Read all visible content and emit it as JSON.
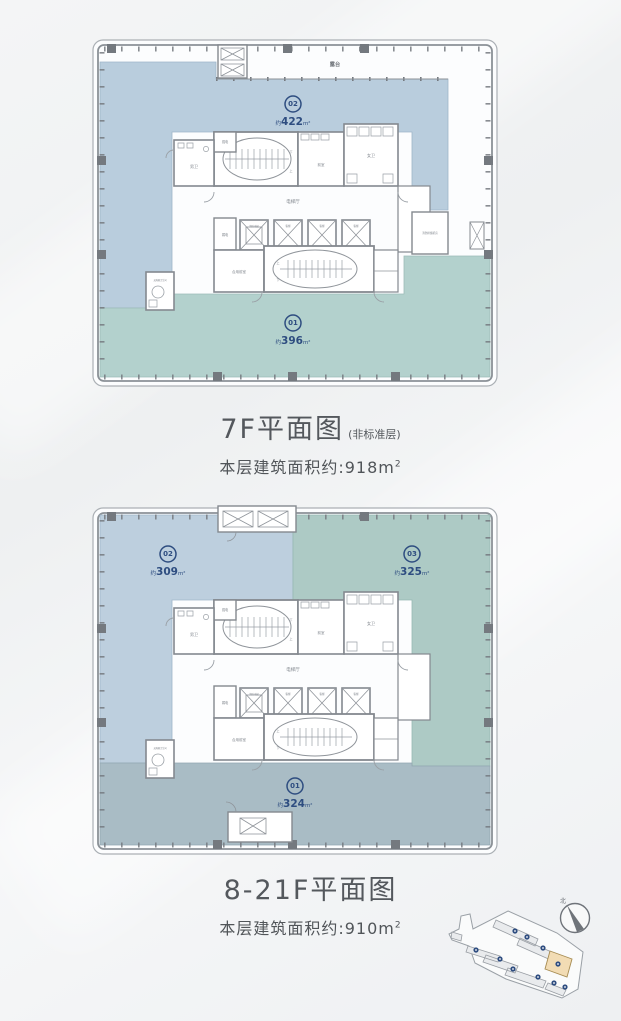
{
  "page": {
    "background_top": "#f4f5f6",
    "background_bottom": "#eef0f2"
  },
  "colors": {
    "badge_blue": "#2e4d80",
    "wall_gray": "#84898f",
    "column_gray": "#74797f",
    "title_gray": "#54585d",
    "label_gray": "#80868d",
    "site_highlight": "#f2dcb4"
  },
  "plan1": {
    "title": "7F平面图",
    "title_note": "(非标准层)",
    "subtitle": "本层建筑面积约:918m",
    "subtitle_sup": "2",
    "units": {
      "u02": {
        "num": "02",
        "prefix": "约",
        "value": "422",
        "suffix": "m²",
        "color": "#b9cddd"
      },
      "u01": {
        "num": "01",
        "prefix": "约",
        "value": "396",
        "suffix": "m²",
        "color": "#b3d1cd"
      }
    },
    "labels": {
      "terrace": "露台",
      "smoke_room": "消防排烟机房"
    }
  },
  "plan2": {
    "title": "8-21F平面图",
    "subtitle": "本层建筑面积约:910m",
    "subtitle_sup": "2",
    "units": {
      "u02": {
        "num": "02",
        "prefix": "约",
        "value": "309",
        "suffix": "m²",
        "color": "#bdcfde"
      },
      "u03": {
        "num": "03",
        "prefix": "约",
        "value": "325",
        "suffix": "m²",
        "color": "#adcac5"
      },
      "u01": {
        "num": "01",
        "prefix": "约",
        "value": "324",
        "suffix": "m²",
        "color": "#a9bcc5"
      }
    }
  },
  "core": {
    "elevator_hall": "电梯厅",
    "male_wc": "男卫",
    "female_wc": "女卫",
    "front_room": "前室",
    "strong_elec": "强电",
    "weak_elec": "弱电",
    "fire_elevator": "消防电梯",
    "passenger_elevator": "客梯",
    "shared_front_room": "合用前室",
    "accessible_wc": "无障碍卫生间",
    "up": "上",
    "down": "下"
  },
  "site_plan": {
    "compass_north": "北"
  }
}
